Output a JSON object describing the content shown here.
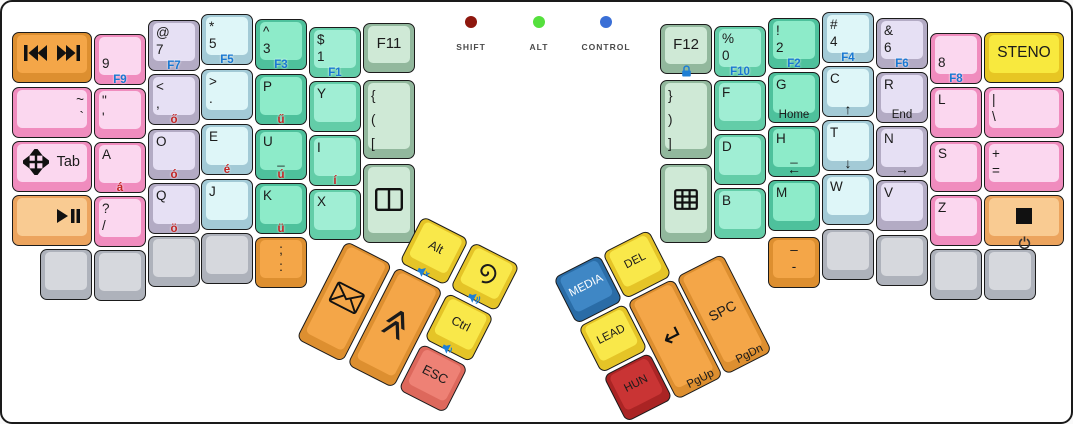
{
  "indicators": {
    "items": [
      {
        "name": "shift",
        "label": "SHIFT",
        "color": "#8e170e",
        "x": 469,
        "y": 20
      },
      {
        "name": "alt",
        "label": "ALT",
        "color": "#55e03d",
        "x": 537,
        "y": 20
      },
      {
        "name": "control",
        "label": "CONTROL",
        "color": "#3a6fd6",
        "x": 604,
        "y": 20
      }
    ]
  },
  "palette": {
    "orange": {
      "rim": "#dd8f30",
      "face": "#f4a648"
    },
    "orangeL": {
      "rim": "#eca45e",
      "face": "#f9cb92"
    },
    "pink": {
      "rim": "#f08cbe",
      "face": "#fbd7ef"
    },
    "lav": {
      "rim": "#b3abc4",
      "face": "#e6e0f4"
    },
    "cyan": {
      "rim": "#a3cad6",
      "face": "#def6f8"
    },
    "mintD": {
      "rim": "#4ec19c",
      "face": "#8debc9"
    },
    "mint": {
      "rim": "#63cda8",
      "face": "#a0eed4"
    },
    "sage": {
      "rim": "#92b89d",
      "face": "#cfe9d6"
    },
    "gray": {
      "rim": "#aeb2bb",
      "face": "#d6d8dd"
    },
    "yellow": {
      "rim": "#e7c623",
      "face": "#f8e93e"
    },
    "yellowT": {
      "rim": "#e5c427",
      "face": "#f9e84a"
    },
    "red": {
      "rim": "#dd685c",
      "face": "#ee8175"
    },
    "redD": {
      "rim": "#aa2424",
      "face": "#c93434"
    },
    "blue": {
      "rim": "#2a6ca6",
      "face": "#3f87c5"
    }
  },
  "main_keys": [
    {
      "name": "key-media-prev-next",
      "x": 10,
      "y": 30,
      "w": 80,
      "h": 51,
      "color": "orange",
      "icons": [
        {
          "glyph": "prev-next",
          "pos": "center"
        }
      ]
    },
    {
      "name": "key-tilde-backtick",
      "x": 10,
      "y": 85,
      "w": 80,
      "h": 51,
      "color": "pink",
      "stack": {
        "lines": [
          "~",
          "`"
        ],
        "align": "right"
      }
    },
    {
      "name": "key-tab",
      "x": 10,
      "y": 139,
      "w": 80,
      "h": 51,
      "color": "pink",
      "icons": [
        {
          "glyph": "move",
          "pos": "left"
        }
      ],
      "label": {
        "text": "Tab",
        "size": 14.5,
        "align": "right"
      }
    },
    {
      "name": "key-play-pause",
      "x": 10,
      "y": 193,
      "w": 80,
      "h": 51,
      "color": "orangeL",
      "icons": [
        {
          "glyph": "play-pause",
          "pos": "rightp"
        }
      ]
    },
    {
      "name": "key-9",
      "x": 92,
      "y": 32,
      "w": 52,
      "h": 51,
      "color": "pink",
      "stack": {
        "lines": [
          " ",
          "9"
        ]
      },
      "f": "F9"
    },
    {
      "name": "key-quote",
      "x": 92,
      "y": 86,
      "w": 52,
      "h": 51,
      "color": "pink",
      "stack": {
        "lines": [
          "\"",
          "'"
        ]
      }
    },
    {
      "name": "key-a",
      "x": 92,
      "y": 140,
      "w": 52,
      "h": 51,
      "color": "pink",
      "stack": {
        "lines": [
          "A"
        ]
      },
      "hu": "á"
    },
    {
      "name": "key-question-slash",
      "x": 92,
      "y": 194,
      "w": 52,
      "h": 51,
      "color": "pink",
      "stack": {
        "lines": [
          "?",
          "/"
        ]
      }
    },
    {
      "name": "key-blank-l1",
      "x": 38,
      "y": 247,
      "w": 52,
      "h": 51,
      "color": "gray"
    },
    {
      "name": "key-blank-l2",
      "x": 92,
      "y": 248,
      "w": 52,
      "h": 51,
      "color": "gray"
    },
    {
      "name": "key-at-7",
      "x": 146,
      "y": 18,
      "w": 52,
      "h": 51,
      "color": "lav",
      "stack": {
        "lines": [
          "@",
          "7"
        ]
      },
      "f": "F7"
    },
    {
      "name": "key-lt-comma",
      "x": 146,
      "y": 72,
      "w": 52,
      "h": 51,
      "color": "lav",
      "stack": {
        "lines": [
          "<",
          ","
        ]
      },
      "hu": "ő"
    },
    {
      "name": "key-o",
      "x": 146,
      "y": 127,
      "w": 52,
      "h": 51,
      "color": "lav",
      "stack": {
        "lines": [
          "O"
        ]
      },
      "hu": "ó"
    },
    {
      "name": "key-q",
      "x": 146,
      "y": 181,
      "w": 52,
      "h": 51,
      "color": "lav",
      "stack": {
        "lines": [
          "Q"
        ]
      },
      "hu": "ö"
    },
    {
      "name": "key-blank-l3",
      "x": 146,
      "y": 234,
      "w": 52,
      "h": 51,
      "color": "gray"
    },
    {
      "name": "key-star-5",
      "x": 199,
      "y": 12,
      "w": 52,
      "h": 51,
      "color": "cyan",
      "stack": {
        "lines": [
          "*",
          "5"
        ]
      },
      "f": "F5"
    },
    {
      "name": "key-gt-period",
      "x": 199,
      "y": 67,
      "w": 52,
      "h": 51,
      "color": "cyan",
      "stack": {
        "lines": [
          ">",
          "."
        ]
      }
    },
    {
      "name": "key-e",
      "x": 199,
      "y": 122,
      "w": 52,
      "h": 51,
      "color": "cyan",
      "stack": {
        "lines": [
          "E"
        ]
      },
      "hu": "é"
    },
    {
      "name": "key-j",
      "x": 199,
      "y": 177,
      "w": 52,
      "h": 51,
      "color": "cyan",
      "stack": {
        "lines": [
          "J"
        ]
      }
    },
    {
      "name": "key-blank-l4",
      "x": 199,
      "y": 231,
      "w": 52,
      "h": 51,
      "color": "gray"
    },
    {
      "name": "key-caret-3",
      "x": 253,
      "y": 17,
      "w": 52,
      "h": 51,
      "color": "mintD",
      "stack": {
        "lines": [
          "^",
          "3"
        ]
      },
      "f": "F3"
    },
    {
      "name": "key-p",
      "x": 253,
      "y": 72,
      "w": 52,
      "h": 51,
      "color": "mintD",
      "stack": {
        "lines": [
          "P"
        ]
      },
      "hu": "ű"
    },
    {
      "name": "key-u",
      "x": 253,
      "y": 127,
      "w": 52,
      "h": 51,
      "color": "mintD",
      "stack": {
        "lines": [
          "U"
        ]
      },
      "hu": "ú",
      "bar": true
    },
    {
      "name": "key-k",
      "x": 253,
      "y": 181,
      "w": 52,
      "h": 51,
      "color": "mintD",
      "stack": {
        "lines": [
          "K"
        ]
      },
      "hu": "ü"
    },
    {
      "name": "key-semicolon-colon",
      "x": 253,
      "y": 235,
      "w": 52,
      "h": 51,
      "color": "orange",
      "stack": {
        "lines": [
          ";",
          ":"
        ],
        "align": "center"
      }
    },
    {
      "name": "key-dollar-1",
      "x": 307,
      "y": 25,
      "w": 52,
      "h": 51,
      "color": "mint",
      "stack": {
        "lines": [
          "$",
          "1"
        ]
      },
      "f": "F1"
    },
    {
      "name": "key-y",
      "x": 307,
      "y": 79,
      "w": 52,
      "h": 51,
      "color": "mint",
      "stack": {
        "lines": [
          "Y"
        ]
      }
    },
    {
      "name": "key-i",
      "x": 307,
      "y": 133,
      "w": 52,
      "h": 51,
      "color": "mint",
      "stack": {
        "lines": [
          "I"
        ]
      },
      "hu": "í"
    },
    {
      "name": "key-x",
      "x": 307,
      "y": 187,
      "w": 52,
      "h": 51,
      "color": "mint",
      "stack": {
        "lines": [
          "X"
        ]
      }
    },
    {
      "name": "key-f11",
      "x": 361,
      "y": 21,
      "w": 52,
      "h": 50,
      "color": "sage",
      "label": {
        "text": "F11",
        "size": 15
      }
    },
    {
      "name": "key-open-brackets",
      "x": 361,
      "y": 78,
      "w": 52,
      "h": 79,
      "color": "sage",
      "stack": {
        "lines": [
          "{",
          "(",
          "["
        ],
        "tall": true
      }
    },
    {
      "name": "key-window-split",
      "x": 361,
      "y": 162,
      "w": 52,
      "h": 79,
      "color": "sage",
      "icons": [
        {
          "glyph": "window",
          "pos": "center"
        }
      ]
    },
    {
      "name": "key-f12",
      "x": 658,
      "y": 22,
      "w": 52,
      "h": 50,
      "color": "sage",
      "label": {
        "text": "F12",
        "size": 15
      },
      "icons": [
        {
          "glyph": "lock",
          "pos": "bottom"
        }
      ]
    },
    {
      "name": "key-close-brackets",
      "x": 658,
      "y": 78,
      "w": 52,
      "h": 79,
      "color": "sage",
      "stack": {
        "lines": [
          "}",
          ")",
          "]"
        ],
        "tall": true
      }
    },
    {
      "name": "key-grid",
      "x": 658,
      "y": 162,
      "w": 52,
      "h": 79,
      "color": "sage",
      "icons": [
        {
          "glyph": "grid",
          "pos": "center"
        }
      ]
    },
    {
      "name": "key-pct-0",
      "x": 712,
      "y": 24,
      "w": 52,
      "h": 51,
      "color": "mint",
      "stack": {
        "lines": [
          "%",
          "0"
        ]
      },
      "f": "F10"
    },
    {
      "name": "key-f",
      "x": 712,
      "y": 78,
      "w": 52,
      "h": 51,
      "color": "mint",
      "stack": {
        "lines": [
          "F"
        ]
      }
    },
    {
      "name": "key-d",
      "x": 712,
      "y": 132,
      "w": 52,
      "h": 51,
      "color": "mint",
      "stack": {
        "lines": [
          "D"
        ]
      }
    },
    {
      "name": "key-b",
      "x": 712,
      "y": 186,
      "w": 52,
      "h": 51,
      "color": "mint",
      "stack": {
        "lines": [
          "B"
        ]
      }
    },
    {
      "name": "key-excl-2",
      "x": 766,
      "y": 16,
      "w": 52,
      "h": 51,
      "color": "mintD",
      "stack": {
        "lines": [
          "!",
          "2"
        ]
      },
      "f": "F2"
    },
    {
      "name": "key-g",
      "x": 766,
      "y": 70,
      "w": 52,
      "h": 51,
      "color": "mintD",
      "stack": {
        "lines": [
          "G"
        ]
      },
      "sub": {
        "text": "Home"
      }
    },
    {
      "name": "key-h",
      "x": 766,
      "y": 124,
      "w": 52,
      "h": 51,
      "color": "mintD",
      "stack": {
        "lines": [
          "H"
        ]
      },
      "bar": true,
      "arrow": "←"
    },
    {
      "name": "key-m",
      "x": 766,
      "y": 178,
      "w": 52,
      "h": 51,
      "color": "mintD",
      "stack": {
        "lines": [
          "M"
        ]
      }
    },
    {
      "name": "key-dash",
      "x": 766,
      "y": 235,
      "w": 52,
      "h": 51,
      "color": "orange",
      "stack": {
        "lines": [
          "–",
          "-"
        ],
        "align": "center"
      }
    },
    {
      "name": "key-hash-4",
      "x": 820,
      "y": 10,
      "w": 52,
      "h": 51,
      "color": "cyan",
      "stack": {
        "lines": [
          "#",
          "4"
        ]
      },
      "f": "F4"
    },
    {
      "name": "key-c",
      "x": 820,
      "y": 64,
      "w": 52,
      "h": 51,
      "color": "cyan",
      "stack": {
        "lines": [
          "C"
        ]
      },
      "arrow": "↑"
    },
    {
      "name": "key-t",
      "x": 820,
      "y": 118,
      "w": 52,
      "h": 51,
      "color": "cyan",
      "stack": {
        "lines": [
          "T"
        ]
      },
      "arrow": "↓"
    },
    {
      "name": "key-w",
      "x": 820,
      "y": 172,
      "w": 52,
      "h": 51,
      "color": "cyan",
      "stack": {
        "lines": [
          "W"
        ]
      }
    },
    {
      "name": "key-blank-r1",
      "x": 820,
      "y": 227,
      "w": 52,
      "h": 51,
      "color": "gray"
    },
    {
      "name": "key-amp-6",
      "x": 874,
      "y": 16,
      "w": 52,
      "h": 51,
      "color": "lav",
      "stack": {
        "lines": [
          "&",
          "6"
        ]
      },
      "f": "F6"
    },
    {
      "name": "key-r",
      "x": 874,
      "y": 70,
      "w": 52,
      "h": 51,
      "color": "lav",
      "stack": {
        "lines": [
          "R"
        ]
      },
      "sub": {
        "text": "End"
      }
    },
    {
      "name": "key-n",
      "x": 874,
      "y": 124,
      "w": 52,
      "h": 51,
      "color": "lav",
      "stack": {
        "lines": [
          "N"
        ]
      },
      "arrow": "→"
    },
    {
      "name": "key-v",
      "x": 874,
      "y": 178,
      "w": 52,
      "h": 51,
      "color": "lav",
      "stack": {
        "lines": [
          "V"
        ]
      }
    },
    {
      "name": "key-blank-r2",
      "x": 874,
      "y": 233,
      "w": 52,
      "h": 51,
      "color": "gray"
    },
    {
      "name": "key-8",
      "x": 928,
      "y": 31,
      "w": 52,
      "h": 51,
      "color": "pink",
      "stack": {
        "lines": [
          " ",
          "8"
        ]
      },
      "f": "F8"
    },
    {
      "name": "key-l",
      "x": 928,
      "y": 85,
      "w": 52,
      "h": 51,
      "color": "pink",
      "stack": {
        "lines": [
          "L"
        ]
      }
    },
    {
      "name": "key-s",
      "x": 928,
      "y": 139,
      "w": 52,
      "h": 51,
      "color": "pink",
      "stack": {
        "lines": [
          "S"
        ]
      }
    },
    {
      "name": "key-z",
      "x": 928,
      "y": 193,
      "w": 52,
      "h": 51,
      "color": "pink",
      "stack": {
        "lines": [
          "Z"
        ]
      }
    },
    {
      "name": "key-blank-r3",
      "x": 928,
      "y": 247,
      "w": 52,
      "h": 51,
      "color": "gray"
    },
    {
      "name": "key-steno",
      "x": 982,
      "y": 30,
      "w": 80,
      "h": 51,
      "color": "yellow",
      "label": {
        "text": "STENO",
        "size": 15.5
      }
    },
    {
      "name": "key-pipe-backslash",
      "x": 982,
      "y": 85,
      "w": 80,
      "h": 51,
      "color": "pink",
      "stack": {
        "lines": [
          "|",
          "\\"
        ]
      }
    },
    {
      "name": "key-plus-equals",
      "x": 982,
      "y": 139,
      "w": 80,
      "h": 51,
      "color": "pink",
      "stack": {
        "lines": [
          "+",
          "="
        ]
      }
    },
    {
      "name": "key-stop-power",
      "x": 982,
      "y": 193,
      "w": 80,
      "h": 51,
      "color": "orangeL",
      "icons": [
        {
          "glyph": "stop",
          "pos": "center"
        },
        {
          "glyph": "power",
          "pos": "bottom"
        }
      ]
    },
    {
      "name": "key-blank-r4",
      "x": 982,
      "y": 247,
      "w": 52,
      "h": 51,
      "color": "gray"
    }
  ],
  "thumb_clusters": [
    {
      "name": "left-thumb-cluster",
      "x": 370,
      "y": 188,
      "rotation": 27,
      "keys": [
        {
          "name": "key-alt",
          "x": 57,
          "y": 0,
          "w": 52,
          "h": 52,
          "color": "yellowT",
          "label": {
            "text": "Alt",
            "size": 12.5
          },
          "icons": [
            {
              "glyph": "vol-mute",
              "pos": "bottom"
            }
          ]
        },
        {
          "name": "key-spiral",
          "x": 114,
          "y": 0,
          "w": 52,
          "h": 52,
          "color": "yellowT",
          "icons": [
            {
              "glyph": "spiral",
              "pos": "center"
            },
            {
              "glyph": "vol-up",
              "pos": "bottom"
            }
          ]
        },
        {
          "name": "key-mail",
          "x": 0,
          "y": 57,
          "w": 52,
          "h": 110,
          "color": "orange",
          "icons": [
            {
              "glyph": "envelope",
              "pos": "center"
            }
          ]
        },
        {
          "name": "key-chevrons",
          "x": 57,
          "y": 57,
          "w": 52,
          "h": 110,
          "color": "orange",
          "icons": [
            {
              "glyph": "chevrons",
              "pos": "center"
            }
          ]
        },
        {
          "name": "key-ctrl",
          "x": 114,
          "y": 57,
          "w": 52,
          "h": 52,
          "color": "yellowT",
          "label": {
            "text": "Ctrl",
            "size": 12.5
          },
          "icons": [
            {
              "glyph": "vol-down",
              "pos": "bottom"
            }
          ]
        },
        {
          "name": "key-esc",
          "x": 114,
          "y": 114,
          "w": 52,
          "h": 52,
          "color": "red",
          "label": {
            "text": "ESC",
            "size": 13
          }
        }
      ]
    },
    {
      "name": "right-thumb-cluster",
      "x": 551,
      "y": 276,
      "rotation": -27,
      "keys": [
        {
          "name": "key-media",
          "x": 0,
          "y": 0,
          "w": 52,
          "h": 52,
          "color": "blue",
          "label": {
            "text": "MEDIA",
            "size": 11.5,
            "color": "#ffffff"
          }
        },
        {
          "name": "key-del",
          "x": 55,
          "y": 0,
          "w": 52,
          "h": 52,
          "color": "yellowT",
          "label": {
            "text": "DEL",
            "size": 11.5
          }
        },
        {
          "name": "key-lead",
          "x": 0,
          "y": 55,
          "w": 52,
          "h": 52,
          "color": "yellowT",
          "label": {
            "text": "LEAD",
            "size": 11.5
          }
        },
        {
          "name": "key-hun",
          "x": 0,
          "y": 110,
          "w": 52,
          "h": 52,
          "color": "redD",
          "label": {
            "text": "HUN",
            "size": 11.5
          }
        },
        {
          "name": "key-enter-pgup",
          "x": 55,
          "y": 55,
          "w": 52,
          "h": 110,
          "color": "orange",
          "icons": [
            {
              "glyph": "enter",
              "pos": "center"
            }
          ],
          "sub": {
            "text": "PgUp",
            "align": "right"
          }
        },
        {
          "name": "key-spc-pgdn",
          "x": 110,
          "y": 55,
          "w": 52,
          "h": 110,
          "color": "orange",
          "label": {
            "text": "SPC",
            "size": 14
          },
          "sub": {
            "text": "PgDn",
            "align": "right"
          }
        }
      ]
    }
  ]
}
